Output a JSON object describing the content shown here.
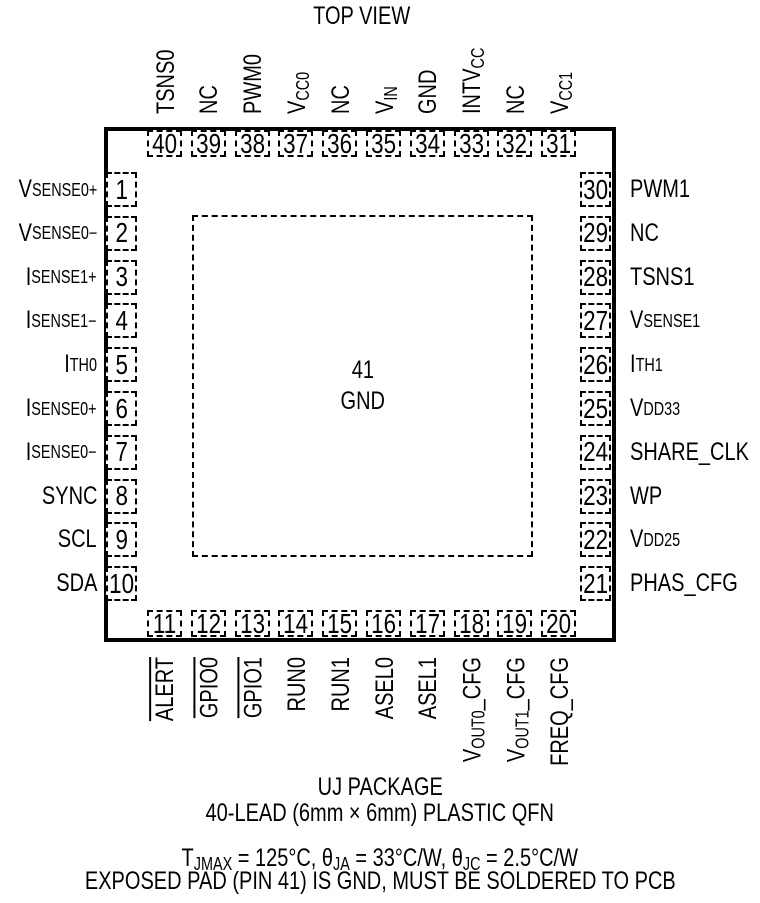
{
  "title": "TOP VIEW",
  "package": {
    "center_pad": {
      "num": "41",
      "label": "GND"
    },
    "pins": {
      "top": [
        {
          "num": "40",
          "label": "TSNS0"
        },
        {
          "num": "39",
          "label": "NC"
        },
        {
          "num": "38",
          "label": "PWM0"
        },
        {
          "num": "37",
          "label": "V~CC0~"
        },
        {
          "num": "36",
          "label": "NC"
        },
        {
          "num": "35",
          "label": "V~IN~"
        },
        {
          "num": "34",
          "label": "GND"
        },
        {
          "num": "33",
          "label": "INTV~CC~"
        },
        {
          "num": "32",
          "label": "NC"
        },
        {
          "num": "31",
          "label": "V~CC1~"
        }
      ],
      "right": [
        {
          "num": "30",
          "label": "PWM1"
        },
        {
          "num": "29",
          "label": "NC"
        },
        {
          "num": "28",
          "label": "TSNS1"
        },
        {
          "num": "27",
          "label": "V~SENSE1~"
        },
        {
          "num": "26",
          "label": "I~TH1~"
        },
        {
          "num": "25",
          "label": "V~DD33~"
        },
        {
          "num": "24",
          "label": "SHARE_CLK"
        },
        {
          "num": "23",
          "label": "WP"
        },
        {
          "num": "22",
          "label": "V~DD25~"
        },
        {
          "num": "21",
          "label": "PHAS_CFG"
        }
      ],
      "left": [
        {
          "num": "1",
          "label": "V~SENSE0~^+^"
        },
        {
          "num": "2",
          "label": "V~SENSE0~^−^"
        },
        {
          "num": "3",
          "label": "I~SENSE1~^+^"
        },
        {
          "num": "4",
          "label": "I~SENSE1~^−^"
        },
        {
          "num": "5",
          "label": "I~TH0~"
        },
        {
          "num": "6",
          "label": "I~SENSE0~^+^"
        },
        {
          "num": "7",
          "label": "I~SENSE0~^−^"
        },
        {
          "num": "8",
          "label": "SYNC"
        },
        {
          "num": "9",
          "label": "SCL"
        },
        {
          "num": "10",
          "label": "SDA"
        }
      ],
      "bottom": [
        {
          "num": "11",
          "label": "|ALERT|"
        },
        {
          "num": "12",
          "label": "|GPIO0|"
        },
        {
          "num": "13",
          "label": "|GPIO1|"
        },
        {
          "num": "14",
          "label": "RUN0"
        },
        {
          "num": "15",
          "label": "RUN1"
        },
        {
          "num": "16",
          "label": "ASEL0"
        },
        {
          "num": "17",
          "label": "ASEL1"
        },
        {
          "num": "18",
          "label": "V~OUT0~_CFG"
        },
        {
          "num": "19",
          "label": "V~OUT1~_CFG"
        },
        {
          "num": "20",
          "label": "FREQ_CFG"
        }
      ]
    }
  },
  "captions": [
    "UJ PACKAGE",
    "40-LEAD (6mm × 6mm) PLASTIC QFN"
  ],
  "notes": [
    "T~JMAX~ = 125°C, θ~JA~ = 33°C/W, θ~JC~ = 2.5°C/W",
    "EXPOSED PAD (PIN 41) IS GND, MUST BE SOLDERED TO PCB"
  ],
  "colors": {
    "ink": "#000000",
    "paper": "#ffffff"
  }
}
